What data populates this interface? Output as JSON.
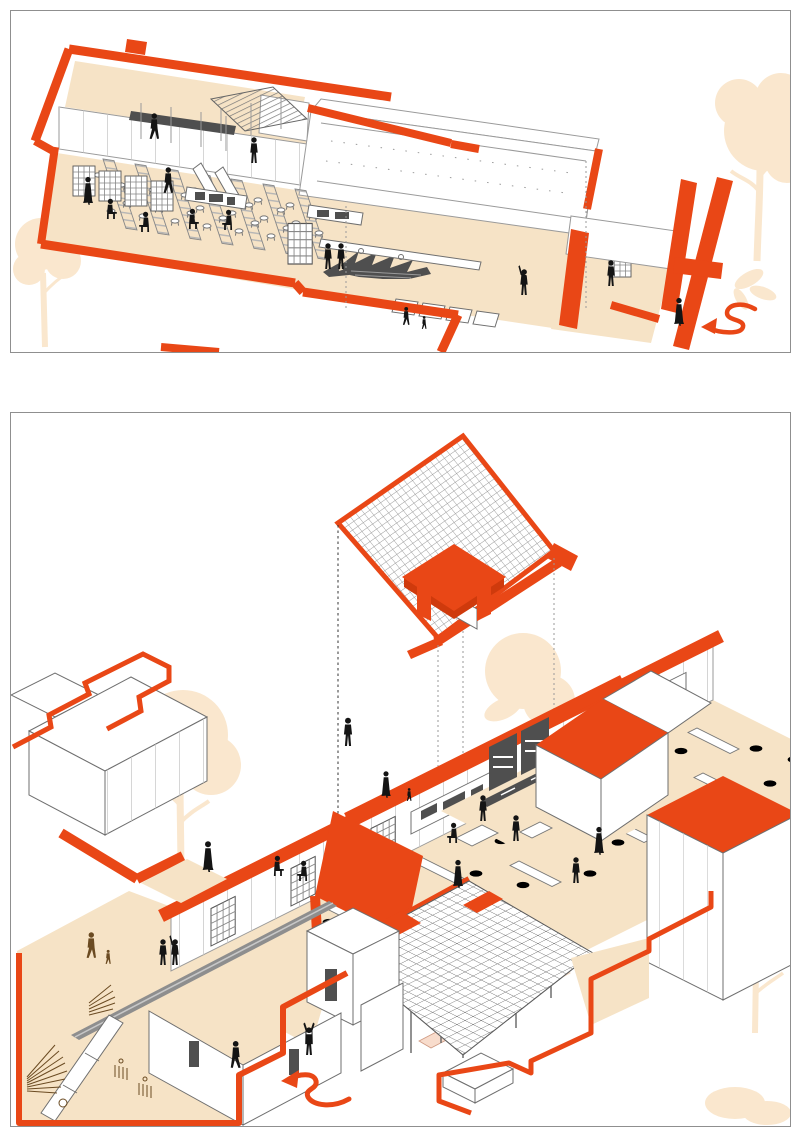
{
  "colors": {
    "paper": "#ffffff",
    "panel_border": "#8f8f8f",
    "orange": "#e94716",
    "orange_dark": "#cf3a0c",
    "floor": "#f6e3c6",
    "tree": "#fae7ce",
    "pink": "#f2c3ae",
    "pink_light": "#f8dccc",
    "ink": "#141414",
    "brown": "#6b4b22",
    "line": "#6f6f6f",
    "line_light": "#9a9a9a",
    "dark": "#4f4f4f",
    "gray_mid": "#8e8e8e"
  },
  "panels": [
    {
      "id": "upper-axon",
      "label": "Upper level cutaway axonometric with entry arrow"
    },
    {
      "id": "ground-axon",
      "label": "Ground level cutaway axonometric with exploded grid roof"
    }
  ]
}
